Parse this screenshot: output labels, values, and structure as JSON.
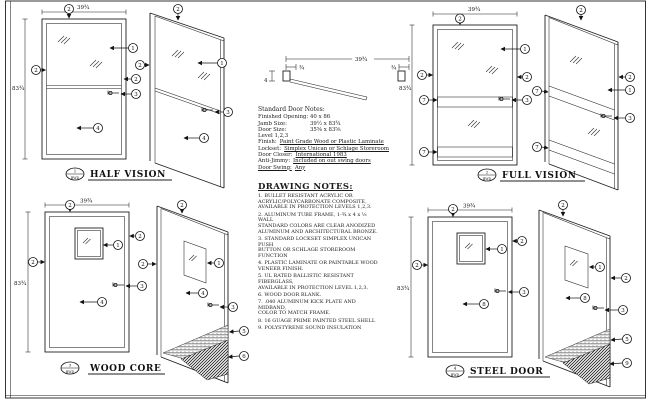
{
  "drawing": {
    "callout_numbers": {
      "n1": "1",
      "n2": "2",
      "n3": "3",
      "n4": "4",
      "n5": "5",
      "n6": "6",
      "n7": "7",
      "n8": "8",
      "n9": "9"
    },
    "views": {
      "half_vision": {
        "title": "HALF VISION",
        "bubble_num": "1",
        "bubble_ref": "BWD"
      },
      "full_vision": {
        "title": "FULL VISION",
        "bubble_num": "2",
        "bubble_ref": "BWD"
      },
      "wood_core": {
        "title": "WOOD CORE",
        "bubble_num": "3",
        "bubble_ref": "BWD"
      },
      "steel_door": {
        "title": "STEEL DOOR",
        "bubble_num": "4",
        "bubble_ref": "BWD"
      }
    },
    "dimensions": {
      "width": "39¾",
      "height": "83¾",
      "jamb_left": "¾",
      "jamb_right": "¾",
      "head_depth": "4"
    },
    "standard_notes": {
      "title": "Standard Door Notes:",
      "rows": [
        {
          "label": "Finished Opening:",
          "value": "40 x 86"
        },
        {
          "label": "Jamb Size:",
          "value": "39½ x 83¾"
        },
        {
          "label": "Door Size:",
          "value": "35⅝ x 83⅝"
        },
        {
          "label": "Level 1,2,3",
          "value": ""
        },
        {
          "label": "Finish:",
          "value": "Paint Grade Wood or Plastic Laminate"
        },
        {
          "label": "Lockset:",
          "value": "Simplex Unican or Schlage Storeroom"
        },
        {
          "label": "Door Closer:",
          "value": "International 1983"
        },
        {
          "label": "Anti-Jimmy:",
          "value": "Included on out swing doors"
        },
        {
          "label": "Door Swing:",
          "value": "Any"
        }
      ]
    },
    "drawing_notes": {
      "title": "DRAWING NOTES:",
      "items": [
        "1.  BULLET RESISTANT ACRYLIC OR\nACRYLIC/POLYCARBONATE COMPOSITE,\nAVAILABLE IN PROTECTION LEVELS 1,2,3.",
        "2.  ALUMINUM TUBE FRAME, 1-¾ x 4 x ⅛ WALL\nSTANDARD COLORS ARE CLEAR ANODIZED\nALUMINUM AND ARCHITECTURAL BRONZE.",
        "3.  STANDARD LOCKSET SIMPLEX UNICAN PUSH\nBUTTON OR SCHLAGE STOREROOM FUNCTION",
        "4.  PLASTIC LAMINATE OR PAINTABLE WOOD\nVENEER FINISH.",
        "5.  UL RATED BALLISTIC RESISTANT FIBERGLASS,\nAVAILABLE IN PROTECTION LEVEL 1,2,3.",
        "6.  WOOD DOOR BLANK.",
        "7.  .040 ALUMINUM KICK PLATE AND MIDBAND,\nCOLOR TO MATCH FRAME.",
        "8.  16 GUAGE PRIME PAINTED STEEL SHELL",
        "9.  POLYSTYRENE SOUND INSULATION"
      ]
    }
  }
}
